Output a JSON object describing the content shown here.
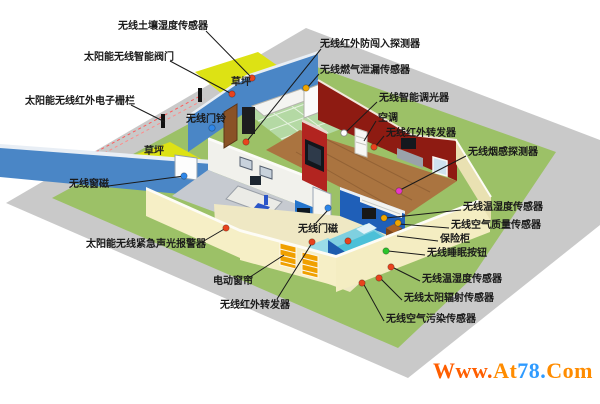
{
  "colors": {
    "dot_red": "#e8431e",
    "dot_yellow": "#f0a500",
    "dot_blue": "#2e86e8",
    "dot_green": "#2bc42b",
    "dot_magenta": "#e838c8",
    "dot_white": "#ffffff",
    "line": "#1a1a1a",
    "lawn": "#dde214",
    "yard": "#9cc167",
    "pavement": "#c9c9c9"
  },
  "ground_labels": [
    {
      "name": "lawn-label-top",
      "text": "草坪",
      "x": 231,
      "y": 77
    },
    {
      "name": "lawn-label-left",
      "text": "草坪",
      "x": 144,
      "y": 146
    }
  ],
  "callouts": [
    {
      "name": "soil-moisture-sensor",
      "label": "无线土壤湿度传感器",
      "x": 118,
      "y": 21,
      "line": [
        206,
        31,
        252,
        78
      ],
      "dot": {
        "x": 252,
        "y": 78,
        "color": "dot_red"
      }
    },
    {
      "name": "smart-valve",
      "label": "太阳能无线智能阀门",
      "x": 84,
      "y": 52,
      "line": [
        170,
        61,
        232,
        94
      ],
      "dot": {
        "x": 232,
        "y": 94,
        "color": "dot_red"
      }
    },
    {
      "name": "electronic-fence",
      "label": "太阳能无线红外电子栅栏",
      "x": 25,
      "y": 96,
      "line": [
        131,
        105,
        165,
        122
      ],
      "dot": null
    },
    {
      "name": "doorbell",
      "label": "无线门铃",
      "x": 186,
      "y": 114,
      "line": null,
      "dot": {
        "x": 212,
        "y": 128,
        "color": "dot_blue"
      }
    },
    {
      "name": "window-magnet",
      "label": "无线窗磁",
      "x": 69,
      "y": 179,
      "line": [
        108,
        186,
        184,
        176
      ],
      "dot": {
        "x": 184,
        "y": 176,
        "color": "dot_blue"
      }
    },
    {
      "name": "emergency-sound-light-alarm",
      "label": "太阳能无线紧急声光报警器",
      "x": 86,
      "y": 239,
      "line": [
        197,
        245,
        226,
        228
      ],
      "dot": {
        "x": 226,
        "y": 228,
        "color": "dot_red"
      }
    },
    {
      "name": "electric-curtain",
      "label": "电动窗帘",
      "x": 213,
      "y": 276,
      "line": [
        247,
        279,
        284,
        255
      ],
      "dot": null
    },
    {
      "name": "ir-transponder-front",
      "label": "无线红外转发器",
      "x": 220,
      "y": 300,
      "line": [
        277,
        299,
        312,
        243
      ],
      "dot": {
        "x": 312,
        "y": 242,
        "color": "dot_red"
      }
    },
    {
      "name": "door-magnet",
      "label": "无线门磁",
      "x": 298,
      "y": 224,
      "line": [
        316,
        223,
        328,
        210
      ],
      "dot": {
        "x": 328,
        "y": 208,
        "color": "dot_blue"
      }
    },
    {
      "name": "ir-intrusion-detector",
      "label": "无线红外防闯入探测器",
      "x": 320,
      "y": 39,
      "line": [
        321,
        49,
        247,
        141
      ],
      "dot": {
        "x": 246,
        "y": 142,
        "color": "dot_red"
      }
    },
    {
      "name": "gas-leak-sensor",
      "label": "无线燃气泄漏传感器",
      "x": 320,
      "y": 65,
      "line": [
        319,
        74,
        307,
        88
      ],
      "dot": {
        "x": 306,
        "y": 88,
        "color": "dot_yellow"
      }
    },
    {
      "name": "smart-dimmer",
      "label": "无线智能调光器",
      "x": 379,
      "y": 93,
      "line": [
        377,
        102,
        345,
        133
      ],
      "dot": {
        "x": 344,
        "y": 133,
        "color": "dot_white"
      }
    },
    {
      "name": "air-conditioner",
      "label": "空调",
      "x": 378,
      "y": 113,
      "line": [
        376,
        121,
        364,
        141
      ],
      "dot": null
    },
    {
      "name": "ir-transponder-living",
      "label": "无线红外转发器",
      "x": 386,
      "y": 128,
      "line": [
        384,
        136,
        375,
        147
      ],
      "dot": {
        "x": 374,
        "y": 147,
        "color": "dot_red"
      }
    },
    {
      "name": "smoke-detector",
      "label": "无线烟感探测器",
      "x": 468,
      "y": 147,
      "line": [
        466,
        156,
        400,
        190
      ],
      "dot": {
        "x": 399,
        "y": 191,
        "color": "dot_magenta"
      }
    },
    {
      "name": "temp-humidity-sensor-bedroom",
      "label": "无线温湿度传感器",
      "x": 463,
      "y": 202,
      "line": [
        461,
        210,
        386,
        218
      ],
      "dot": {
        "x": 384,
        "y": 218,
        "color": "dot_yellow"
      }
    },
    {
      "name": "air-quality-sensor",
      "label": "无线空气质量传感器",
      "x": 451,
      "y": 220,
      "line": [
        449,
        228,
        399,
        224
      ],
      "dot": {
        "x": 398,
        "y": 223,
        "color": "dot_yellow"
      }
    },
    {
      "name": "safe-box",
      "label": "保险柜",
      "x": 440,
      "y": 234,
      "line": [
        438,
        241,
        397,
        236
      ],
      "dot": null
    },
    {
      "name": "sleep-button",
      "label": "无线睡眠按钮",
      "x": 427,
      "y": 248,
      "line": [
        425,
        255,
        388,
        251
      ],
      "dot": {
        "x": 386,
        "y": 251,
        "color": "dot_green"
      }
    },
    {
      "name": "temp-humidity-sensor-outdoor",
      "label": "无线温湿度传感器",
      "x": 422,
      "y": 274,
      "line": [
        420,
        281,
        392,
        267
      ],
      "dot": {
        "x": 391,
        "y": 267,
        "color": "dot_red"
      }
    },
    {
      "name": "solar-radiation-sensor",
      "label": "无线太阳辐射传感器",
      "x": 404,
      "y": 293,
      "line": [
        402,
        300,
        380,
        278
      ],
      "dot": {
        "x": 379,
        "y": 278,
        "color": "dot_red"
      }
    },
    {
      "name": "air-pollution-sensor",
      "label": "无线空气污染传感器",
      "x": 386,
      "y": 314,
      "line": [
        384,
        321,
        363,
        283
      ],
      "dot": {
        "x": 362,
        "y": 283,
        "color": "dot_red"
      }
    }
  ],
  "extra_dots": [
    {
      "name": "transponder-dot-roof",
      "x": 348,
      "y": 241,
      "color": "dot_red"
    }
  ],
  "watermark": {
    "segments": [
      {
        "text": "Www.",
        "color": "#ff5e00"
      },
      {
        "text": "At",
        "color": "#ff8c00"
      },
      {
        "text": "78.",
        "color": "#2f9bff"
      },
      {
        "text": "Com",
        "color": "#ff8c00"
      }
    ]
  }
}
